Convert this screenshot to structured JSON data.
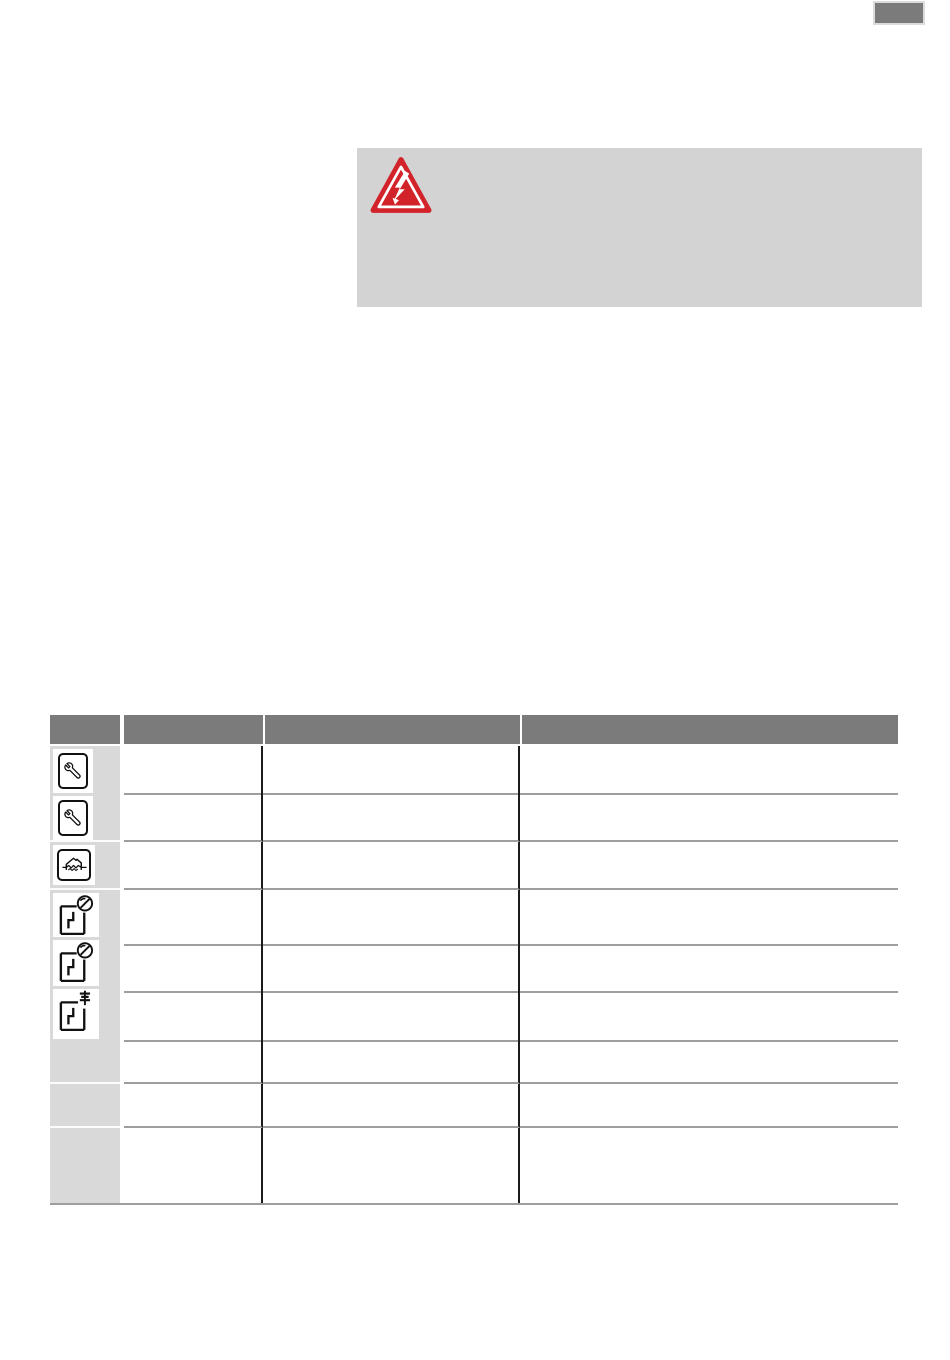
{
  "page": {
    "badge_label": "",
    "badge_color": "#7b7b7b"
  },
  "warning": {
    "icon": "high-voltage-warning-icon",
    "icon_color": "#d2232a",
    "box_color": "#d3d3d3",
    "text": ""
  },
  "table": {
    "header": {
      "color": "#7b7b7b",
      "columns": [
        "",
        "",
        "",
        ""
      ]
    },
    "icon_column_color": "#d9d9d9",
    "divider_color": "#1b1b1b",
    "separator_color": "#9e9e9e",
    "rows": [
      {
        "icon": "wrench-icon",
        "cells": [
          "",
          "",
          ""
        ]
      },
      {
        "icon": "wrench-icon",
        "cells": [
          "",
          "",
          ""
        ]
      },
      {
        "icon": "moisture-protection-icon",
        "cells": [
          "",
          "",
          ""
        ]
      },
      {
        "icon": "pressure-switch-icon",
        "cells": [
          "",
          "",
          ""
        ]
      },
      {
        "icon": "pressure-switch-icon",
        "cells": [
          "",
          "",
          ""
        ]
      },
      {
        "icon": "level-electrode-switch-icon",
        "cells": [
          "",
          "",
          ""
        ]
      },
      {
        "icon": null,
        "cells": [
          "",
          "",
          ""
        ]
      },
      {
        "icon": null,
        "cells": [
          "",
          "",
          ""
        ]
      },
      {
        "icon": null,
        "cells": [
          "",
          "",
          ""
        ]
      }
    ]
  }
}
